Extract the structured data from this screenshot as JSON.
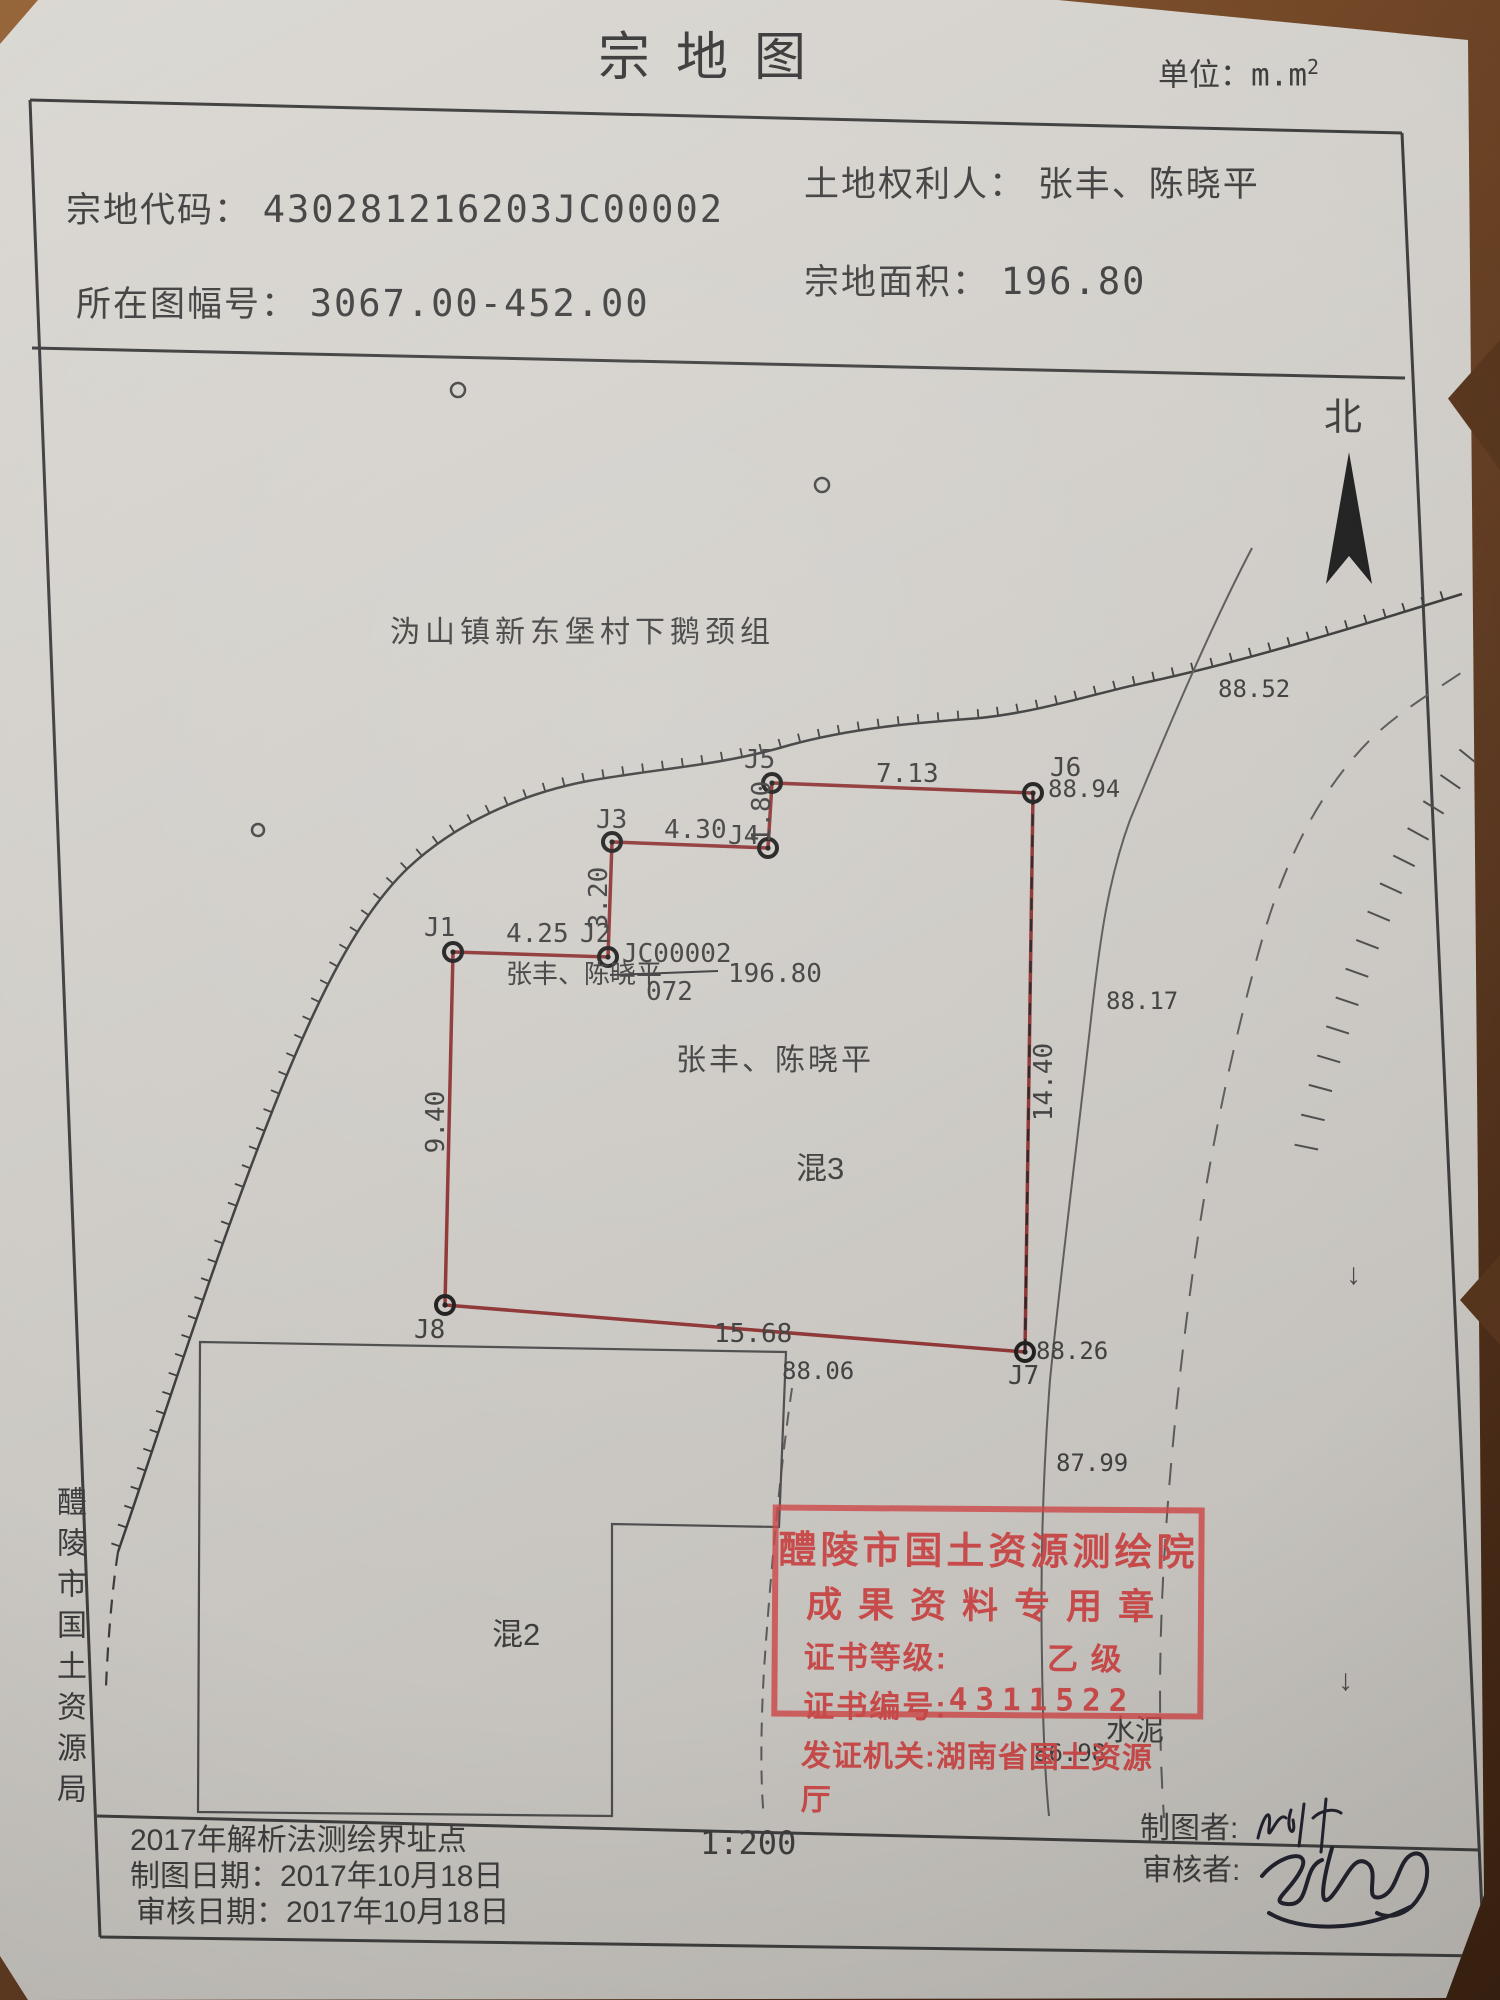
{
  "page": {
    "title": "宗地图",
    "unit_label": "单位：",
    "unit_value": "m.m",
    "unit_exp": "2"
  },
  "header": {
    "parcel_code_label": "宗地代码：",
    "parcel_code": "430281216203JC00002",
    "rights_holder_label": "土地权利人：",
    "rights_holder": "张丰、陈晓平",
    "sheet_no_label": "所在图幅号：",
    "sheet_no": "3067.00-452.00",
    "area_label": "宗地面积：",
    "area": "196.80"
  },
  "map": {
    "north": "北",
    "village": "沩山镇新东堡村下鹅颈组",
    "points": {
      "j1": "J1",
      "j2": "J2",
      "j3": "J3",
      "j4": "J4",
      "j5": "J5",
      "j6": "J6",
      "j7": "J7",
      "j8": "J8"
    },
    "lengths": {
      "j1j2": "4.25",
      "j2j3": "3.20",
      "j3j4": "4.30",
      "j4j5": "1.80",
      "j5j6": "7.13",
      "j6j7": "14.40",
      "j8j7": "15.68",
      "j8j1": "9.40"
    },
    "elevations": [
      "88.52",
      "88.94",
      "88.17",
      "88.26",
      "88.06",
      "87.99",
      "86.98"
    ],
    "annotation": {
      "holder": "张丰、陈晓平",
      "code": "JC00002",
      "number": "072",
      "area": "196.80"
    },
    "holder_center": "张丰、陈晓平",
    "structure3": "混3",
    "structure2": "混2",
    "surface": "水泥",
    "flow_arrow": "↓"
  },
  "stamp": {
    "line1": "醴陵市国土资源测绘院",
    "line2": "成果资料专用章",
    "grade_label": "证书等级:",
    "grade": "乙 级",
    "cert_label": "证书编号:",
    "cert_no": "4311522",
    "issuer_label": "发证机关:",
    "issuer": "湖南省国土资源厅"
  },
  "side_text": "醴陵市国土资源局",
  "footer": {
    "method": "2017年解析法测绘界址点",
    "draw_date_label": "制图日期：",
    "draw_date": "2017年10月18日",
    "review_date_label": "审核日期：",
    "review_date": "2017年10月18日",
    "scale": "1:200",
    "drafter_label": "制图者:",
    "reviewer_label": "审核者:"
  },
  "colors": {
    "boundary_red": "#8c3232",
    "stamp_red": "#c94a4a",
    "ink": "#3d3d3d",
    "paper": "#cdcac5",
    "table": "#6b4326"
  }
}
